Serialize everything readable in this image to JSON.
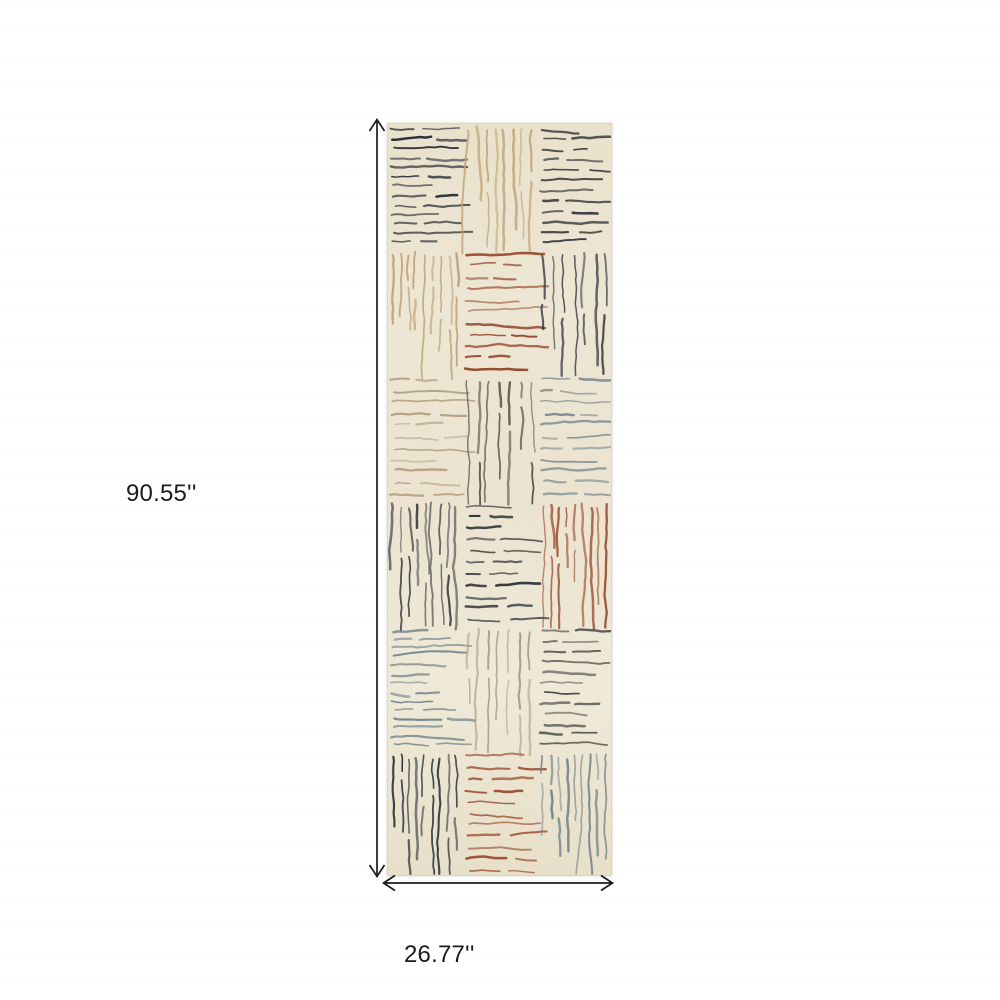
{
  "page": {
    "background": "#ffffff"
  },
  "annotations": {
    "height_label": "90.55''",
    "width_label": "26.77''",
    "arrow_color": "#1b1b1b",
    "text_color": "#1b1b1b"
  },
  "rug": {
    "base_color": "#f1e9d5",
    "edge_color": "#d9d0b8",
    "rows": 6,
    "cols": 3,
    "palette": {
      "navy": "#2c313a",
      "charcoal": "#45474a",
      "dark_grey": "#4a4c49",
      "tan": "#c2a47a",
      "light_tan": "#b2a07e",
      "umber": "#5b5342",
      "rust": "#97492c",
      "slate": "#75878e",
      "light_grey": "#a89f8a"
    },
    "blocks": [
      {
        "row": 0,
        "col": 0,
        "orientation": "horizontal",
        "color": "#2c313a",
        "tone": "navy"
      },
      {
        "row": 0,
        "col": 1,
        "orientation": "vertical",
        "color": "#c2a47a",
        "tone": "tan"
      },
      {
        "row": 0,
        "col": 2,
        "orientation": "horizontal",
        "color": "#3d4042",
        "tone": "charcoal"
      },
      {
        "row": 1,
        "col": 0,
        "orientation": "vertical",
        "color": "#c2a47a",
        "tone": "tan"
      },
      {
        "row": 1,
        "col": 1,
        "orientation": "horizontal",
        "color": "#97492c",
        "tone": "rust"
      },
      {
        "row": 1,
        "col": 2,
        "orientation": "vertical",
        "color": "#2c313a",
        "tone": "navy"
      },
      {
        "row": 2,
        "col": 0,
        "orientation": "horizontal",
        "color": "#b2a07e",
        "tone": "light-tan"
      },
      {
        "row": 2,
        "col": 1,
        "orientation": "vertical",
        "color": "#5b5342",
        "tone": "umber"
      },
      {
        "row": 2,
        "col": 2,
        "orientation": "horizontal",
        "color": "#75878e",
        "tone": "slate"
      },
      {
        "row": 3,
        "col": 0,
        "orientation": "vertical",
        "color": "#45474a",
        "tone": "charcoal"
      },
      {
        "row": 3,
        "col": 1,
        "orientation": "horizontal",
        "color": "#2c313a",
        "tone": "navy"
      },
      {
        "row": 3,
        "col": 2,
        "orientation": "vertical",
        "color": "#97492c",
        "tone": "rust"
      },
      {
        "row": 4,
        "col": 0,
        "orientation": "horizontal",
        "color": "#75878e",
        "tone": "slate"
      },
      {
        "row": 4,
        "col": 1,
        "orientation": "vertical",
        "color": "#a89f8a",
        "tone": "light-grey"
      },
      {
        "row": 4,
        "col": 2,
        "orientation": "horizontal",
        "color": "#4a4c49",
        "tone": "dark-grey"
      },
      {
        "row": 5,
        "col": 0,
        "orientation": "vertical",
        "color": "#2c313a",
        "tone": "navy"
      },
      {
        "row": 5,
        "col": 1,
        "orientation": "horizontal",
        "color": "#97492c",
        "tone": "rust"
      },
      {
        "row": 5,
        "col": 2,
        "orientation": "vertical",
        "color": "#75878e",
        "tone": "slate"
      }
    ]
  }
}
